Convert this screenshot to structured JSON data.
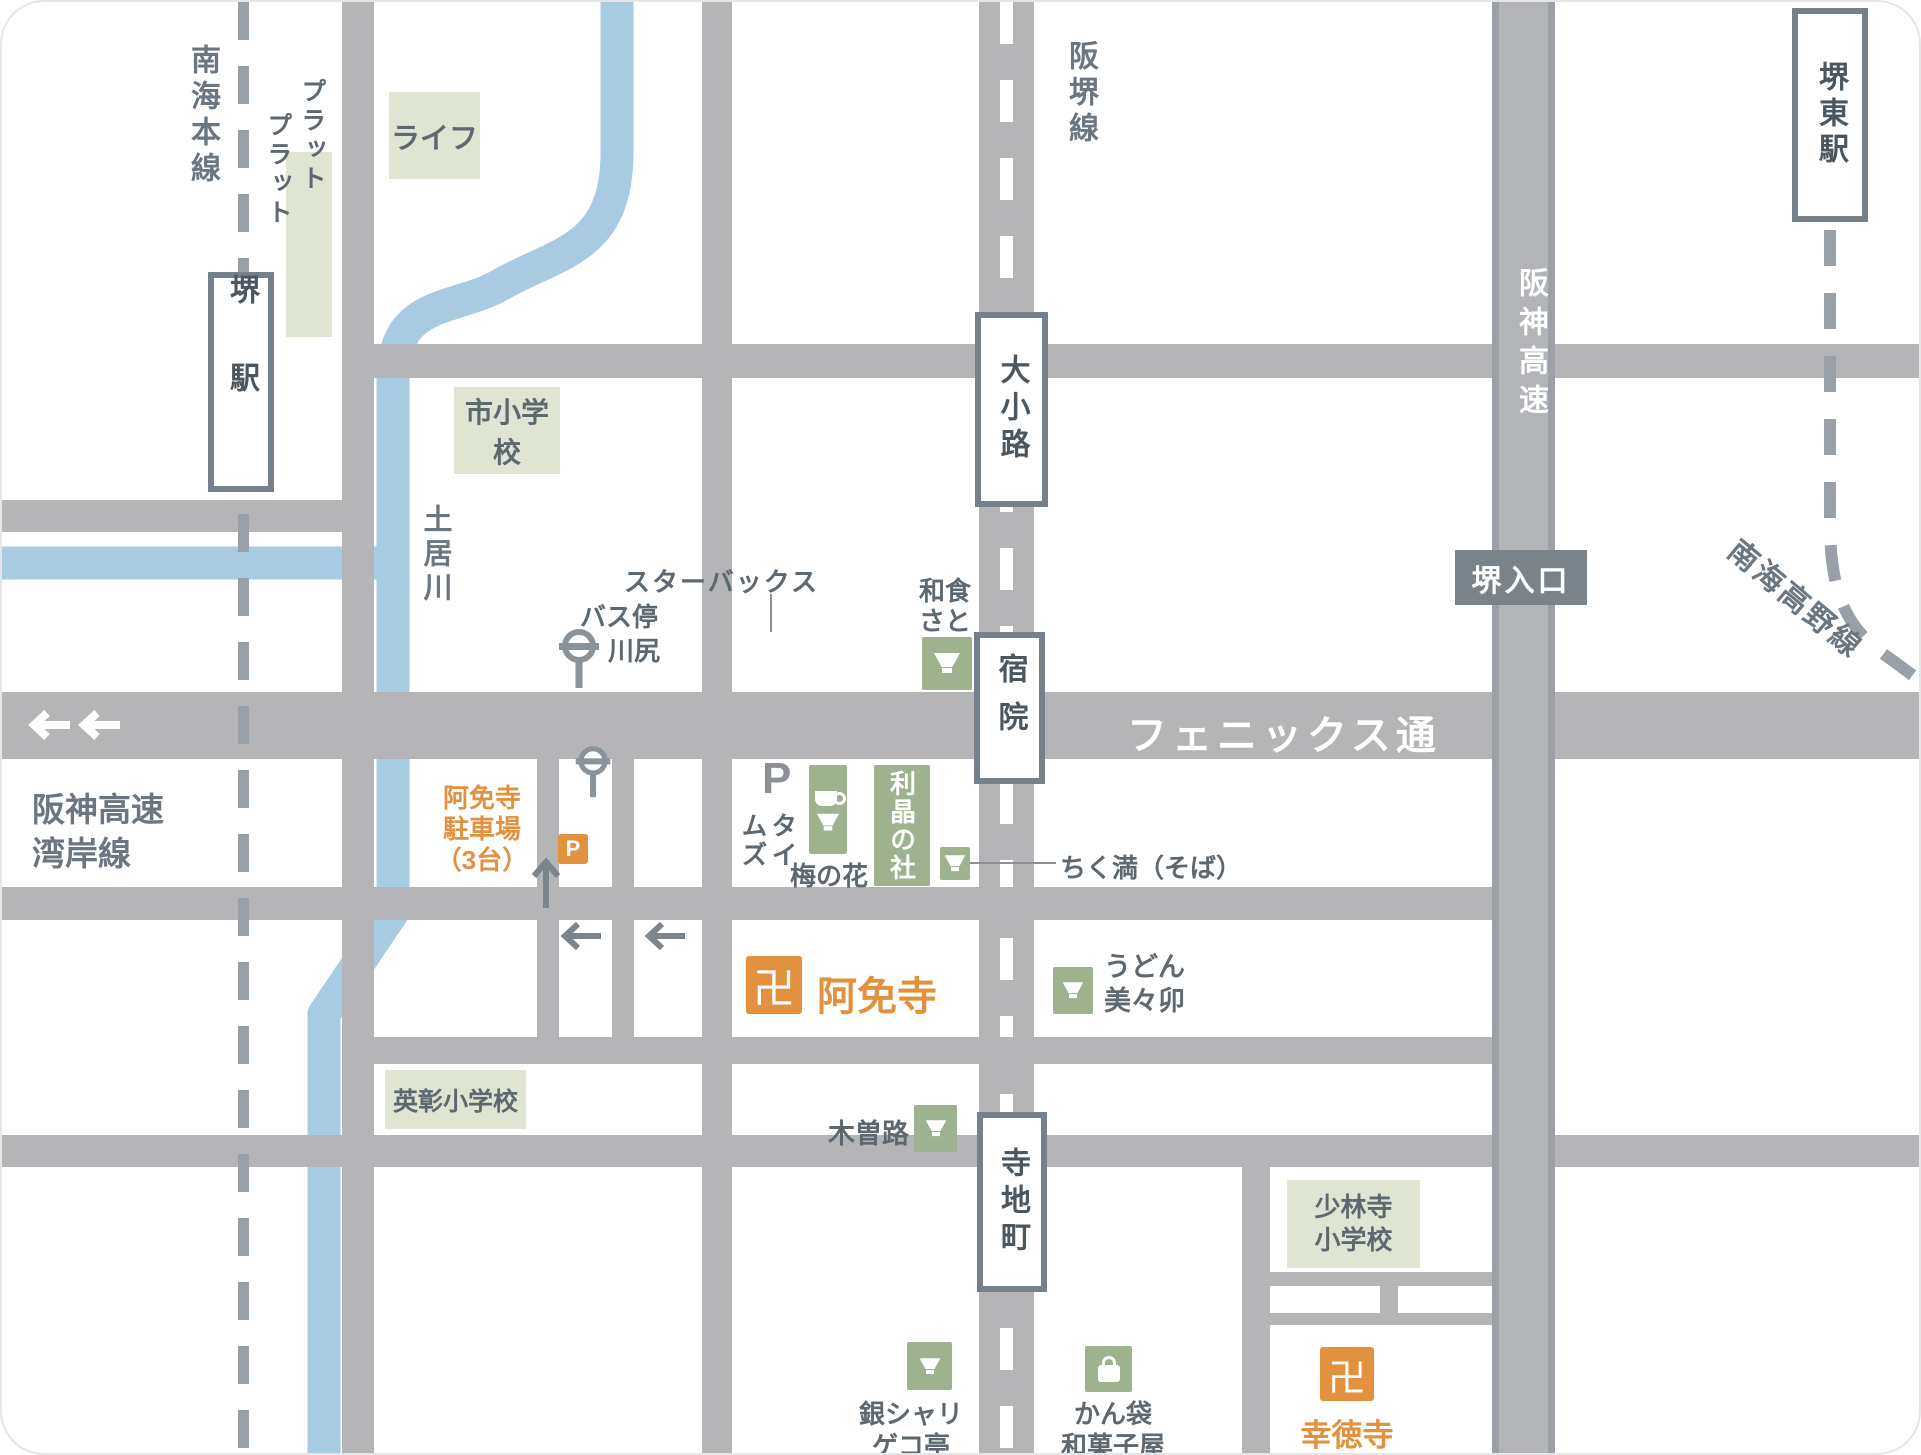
{
  "colors": {
    "road": "#b5b5b8",
    "road_edge": "#9aa0a6",
    "river": "#a9cbe2",
    "green_icon_box": "#9db28d",
    "building_block": "#dfe4d3",
    "accent_orange": "#e2923f",
    "text_gray": "#5d6870",
    "line_label_gray": "#6b7681",
    "station_border": "#76808a",
    "rail_dash": "#99a0a8",
    "sign_bg": "#7b838a"
  },
  "rail_lines": {
    "nankai_main": "南海本線",
    "hankai_line": "阪堺線",
    "hanshin_expwy": "阪神高速",
    "nankai_koya": "南海高野線",
    "hanshin_expwy_wangan": [
      "阪神高速",
      "湾岸線"
    ]
  },
  "roads": {
    "phoenix_street": "フェニックス通"
  },
  "stations": {
    "sakai": "堺駅",
    "sakai_higashi": "堺東駅",
    "oshoji": "大小路",
    "shukuin": "宿院",
    "terajicho": "寺地町",
    "sakai_entrance": "堺入口"
  },
  "places": {
    "platplat": [
      "プラット",
      "プラット"
    ],
    "life": "ライフ",
    "ichi_elementary": "市小学校",
    "doigawa": "土居川",
    "bus_stop": [
      "バス停",
      "川尻"
    ],
    "washoku_sato": [
      "和食",
      "さと"
    ],
    "starbucks": "スターバックス",
    "parking_p": "P",
    "times": [
      "タイ",
      "ムズ"
    ],
    "umenohana": "梅の花",
    "risho_no_mori": "利晶の社",
    "chikuma_soba": "ちく満（そば）",
    "amenji_parking": [
      "阿免寺",
      "駐車場",
      "（3台）"
    ],
    "amenji": "阿免寺",
    "manji": "卍",
    "p_mark": "P",
    "udon_mimiu": [
      "うどん",
      "美々卯"
    ],
    "eisho_elementary": "英彰小学校",
    "kisoji": "木曽路",
    "ginshari_gekotei": [
      "銀シャリ",
      "ゲコ亭"
    ],
    "kanbukuro_wagashiya": [
      "かん袋",
      "和菓子屋"
    ],
    "shorinji_elementary": [
      "少林寺",
      "小学校"
    ],
    "kotokuji": "幸徳寺"
  }
}
